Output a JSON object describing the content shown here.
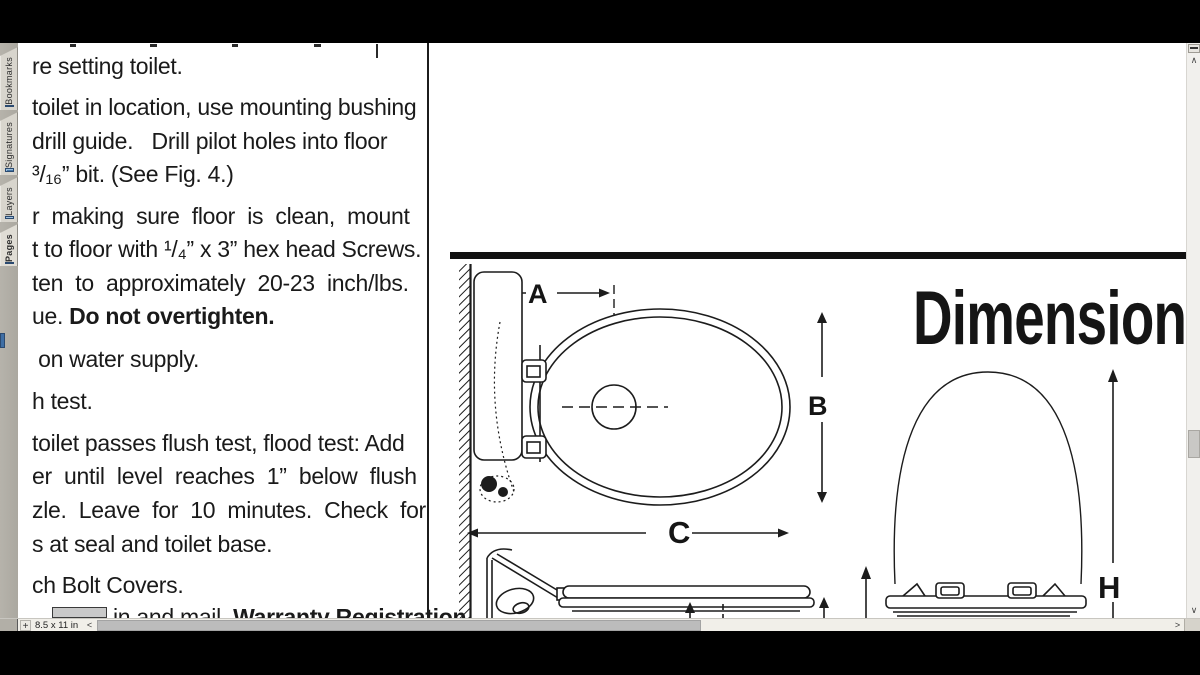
{
  "sidebar": {
    "tabs": [
      {
        "label": "Bookmarks"
      },
      {
        "label": "Signatures"
      },
      {
        "label": "Layers"
      },
      {
        "label": "Pages"
      }
    ]
  },
  "document": {
    "title": "Dimensions",
    "lines": [
      {
        "t": "re setting toilet."
      },
      {
        "t": "toilet in location, use mounting bushing"
      },
      {
        "t": "drill guide.   Drill pilot holes into floor"
      },
      {
        "t": "³/₁₆” bit. (See Fig. 4.)"
      },
      {
        "t": "r  making  sure  floor  is  clean,  mount"
      },
      {
        "t": "t to floor with ¹/₄” x 3” hex head Screws."
      },
      {
        "t": "ten  to  approximately  20-23  inch/lbs."
      },
      {
        "pre": "ue. ",
        "bold": "Do not overtighten."
      },
      {
        "t": " on water supply."
      },
      {
        "t": "h test."
      },
      {
        "t": "toilet passes flush test, flood test: Add"
      },
      {
        "t": "er  until  level  reaches  1”  below  flush"
      },
      {
        "t": "zle.  Leave  for  10  minutes.  Check  for"
      },
      {
        "t": "s at seal and toilet base."
      },
      {
        "t": "ch Bolt Covers."
      },
      {
        "pre": "in and mail  ",
        "bold": "Warranty Registration"
      }
    ],
    "dim_labels": {
      "a": "A",
      "b": "B",
      "c": "C",
      "h": "H"
    }
  },
  "statusbar": {
    "page_size": "8.5 x 11 in",
    "plus": "+",
    "left_arrow": "<",
    "right_arrow": ">"
  },
  "vscroll": {
    "up": "∧",
    "down": "∨"
  },
  "colors": {
    "accent_blue": "#4577a8",
    "sidebar_gray": "#b3b0a8",
    "tab_gray": "#d8d5cd",
    "status_gray": "#f1efe9",
    "ink": "#1c1c1c",
    "bezel": "#000000"
  }
}
